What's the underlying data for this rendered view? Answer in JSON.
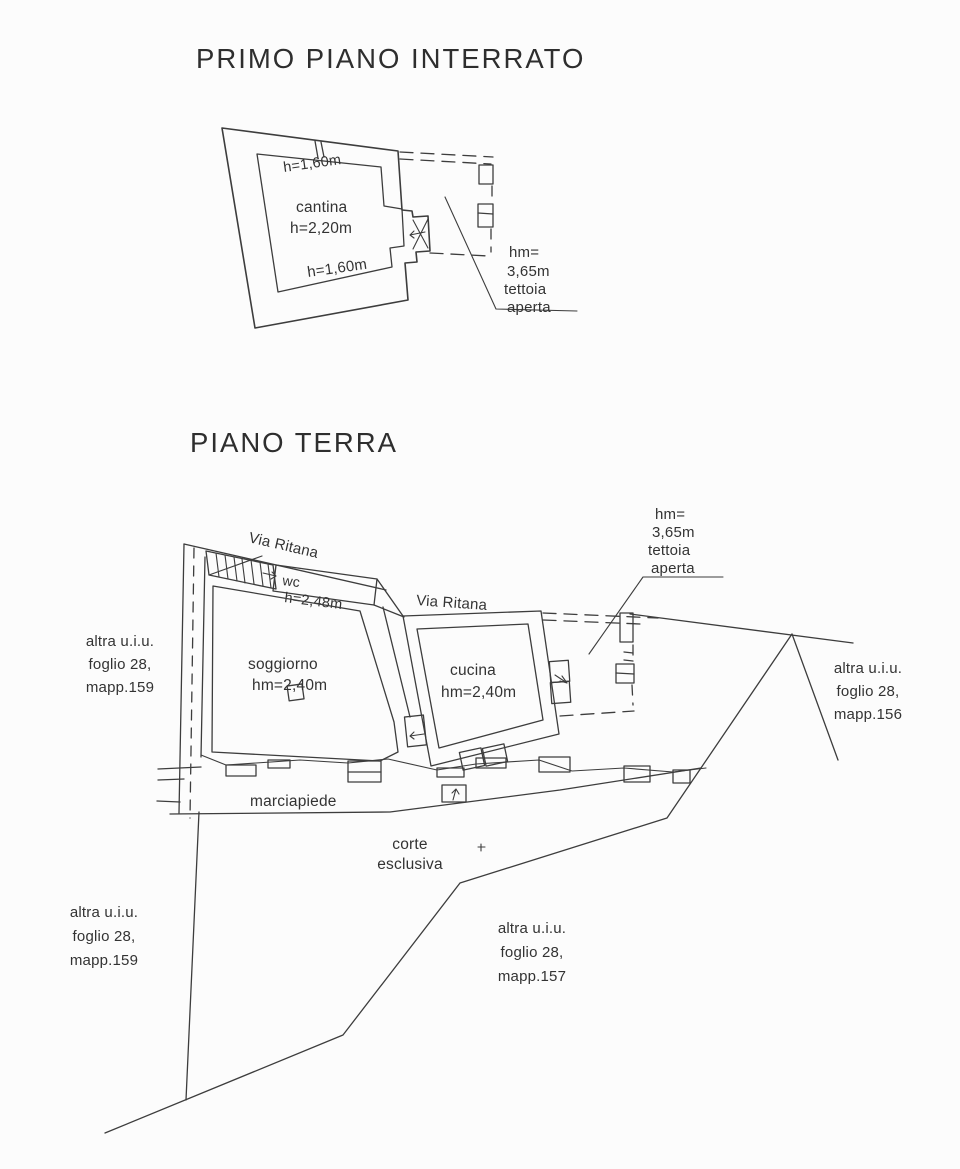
{
  "page": {
    "background": "#fcfcfc",
    "ink": "#3d3d3d"
  },
  "plans": {
    "basement": {
      "title": "PRIMO PIANO INTERRATO",
      "room_cantina_name": "cantina",
      "room_cantina_height": "h=2,20m",
      "height_label_top": "h=1,60m",
      "height_label_bottom": "h=1,60m",
      "note": [
        "hm=",
        "3,65m",
        "tettoia",
        "aperta"
      ]
    },
    "ground": {
      "title": "PIANO TERRA",
      "street_label_west": "Via Ritana",
      "street_label_east": "Via Ritana",
      "room_wc_name": "wc",
      "room_wc_height": "h=2,48m",
      "room_soggiorno_name": "soggiorno",
      "room_soggiorno_height": "hm=2,40m",
      "room_cucina_name": "cucina",
      "room_cucina_height": "hm=2,40m",
      "note": [
        "hm=",
        "3,65m",
        "tettoia",
        "aperta"
      ],
      "sidewalk": "marciapiede",
      "courtyard": [
        "corte",
        "esclusiva"
      ],
      "parcel_west_upper": [
        "altra u.i.u.",
        "foglio 28,",
        "mapp.159"
      ],
      "parcel_east": [
        "altra u.i.u.",
        "foglio 28,",
        "mapp.156"
      ],
      "parcel_west_lower": [
        "altra u.i.u.",
        "foglio 28,",
        "mapp.159"
      ],
      "parcel_south": [
        "altra u.i.u.",
        "foglio 28,",
        "mapp.157"
      ]
    }
  }
}
